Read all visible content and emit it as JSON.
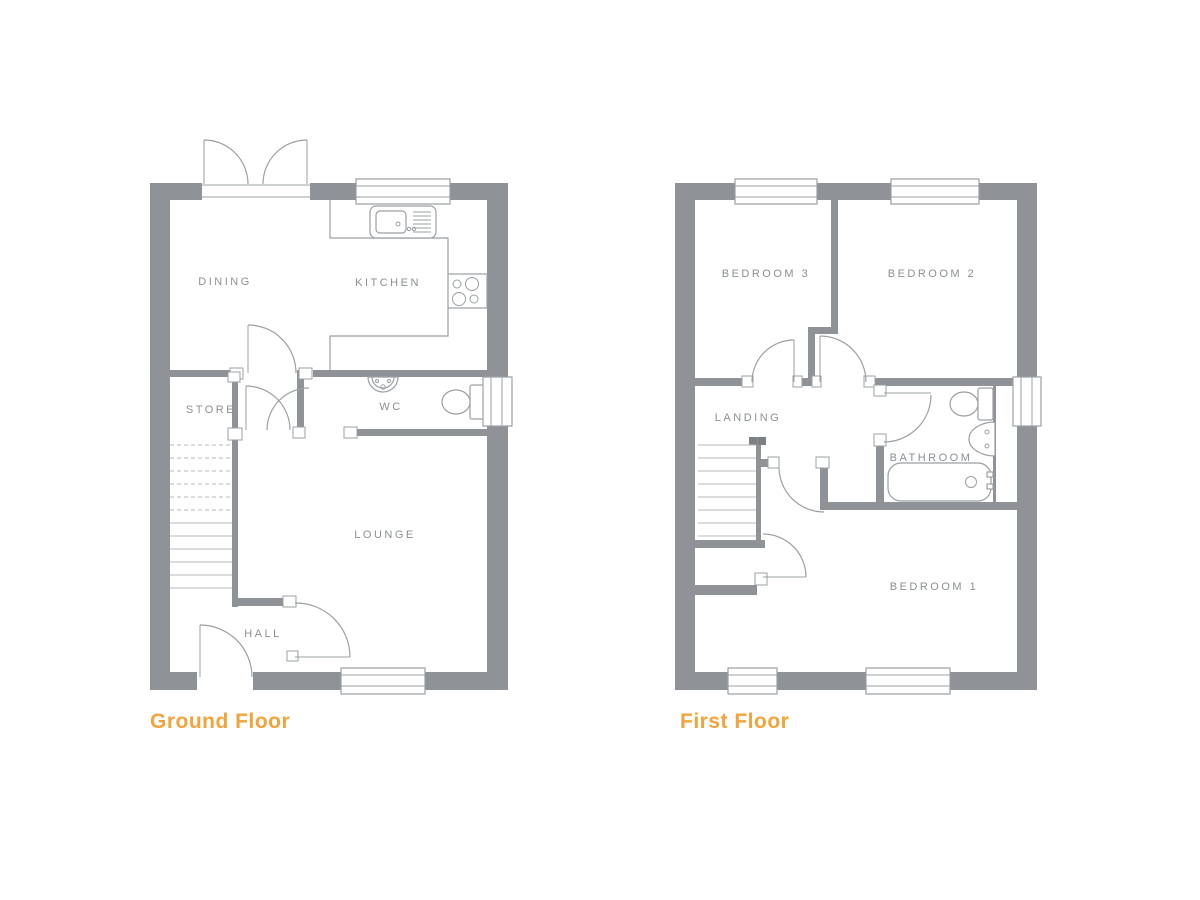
{
  "document_title": "House floor plan drawing, two storeys",
  "colors": {
    "wall": "#8f9296",
    "line": "#9aa0a3",
    "tread": "#b5babc",
    "label": "#8a9093",
    "accent": "#f2a33c",
    "post": "#7e8184"
  },
  "ground": {
    "title": "Ground Floor",
    "rooms": {
      "dining": "DINING",
      "kitchen": "KITCHEN",
      "store": "STORE",
      "wc": "WC",
      "lounge": "LOUNGE",
      "hall": "HALL"
    },
    "fixtures": [
      "kitchen-sink",
      "hob",
      "wash-basin",
      "toilet",
      "staircase",
      "french-doors",
      "front-door",
      "window"
    ]
  },
  "first": {
    "title": "First Floor",
    "rooms": {
      "bedroom3": "BEDROOM 3",
      "bedroom2": "BEDROOM 2",
      "landing": "LANDING",
      "bathroom": "BATHROOM",
      "bedroom1": "BEDROOM 1"
    },
    "fixtures": [
      "toilet",
      "wash-basin",
      "bath",
      "staircase",
      "over-stairs-cupboard",
      "window"
    ]
  }
}
